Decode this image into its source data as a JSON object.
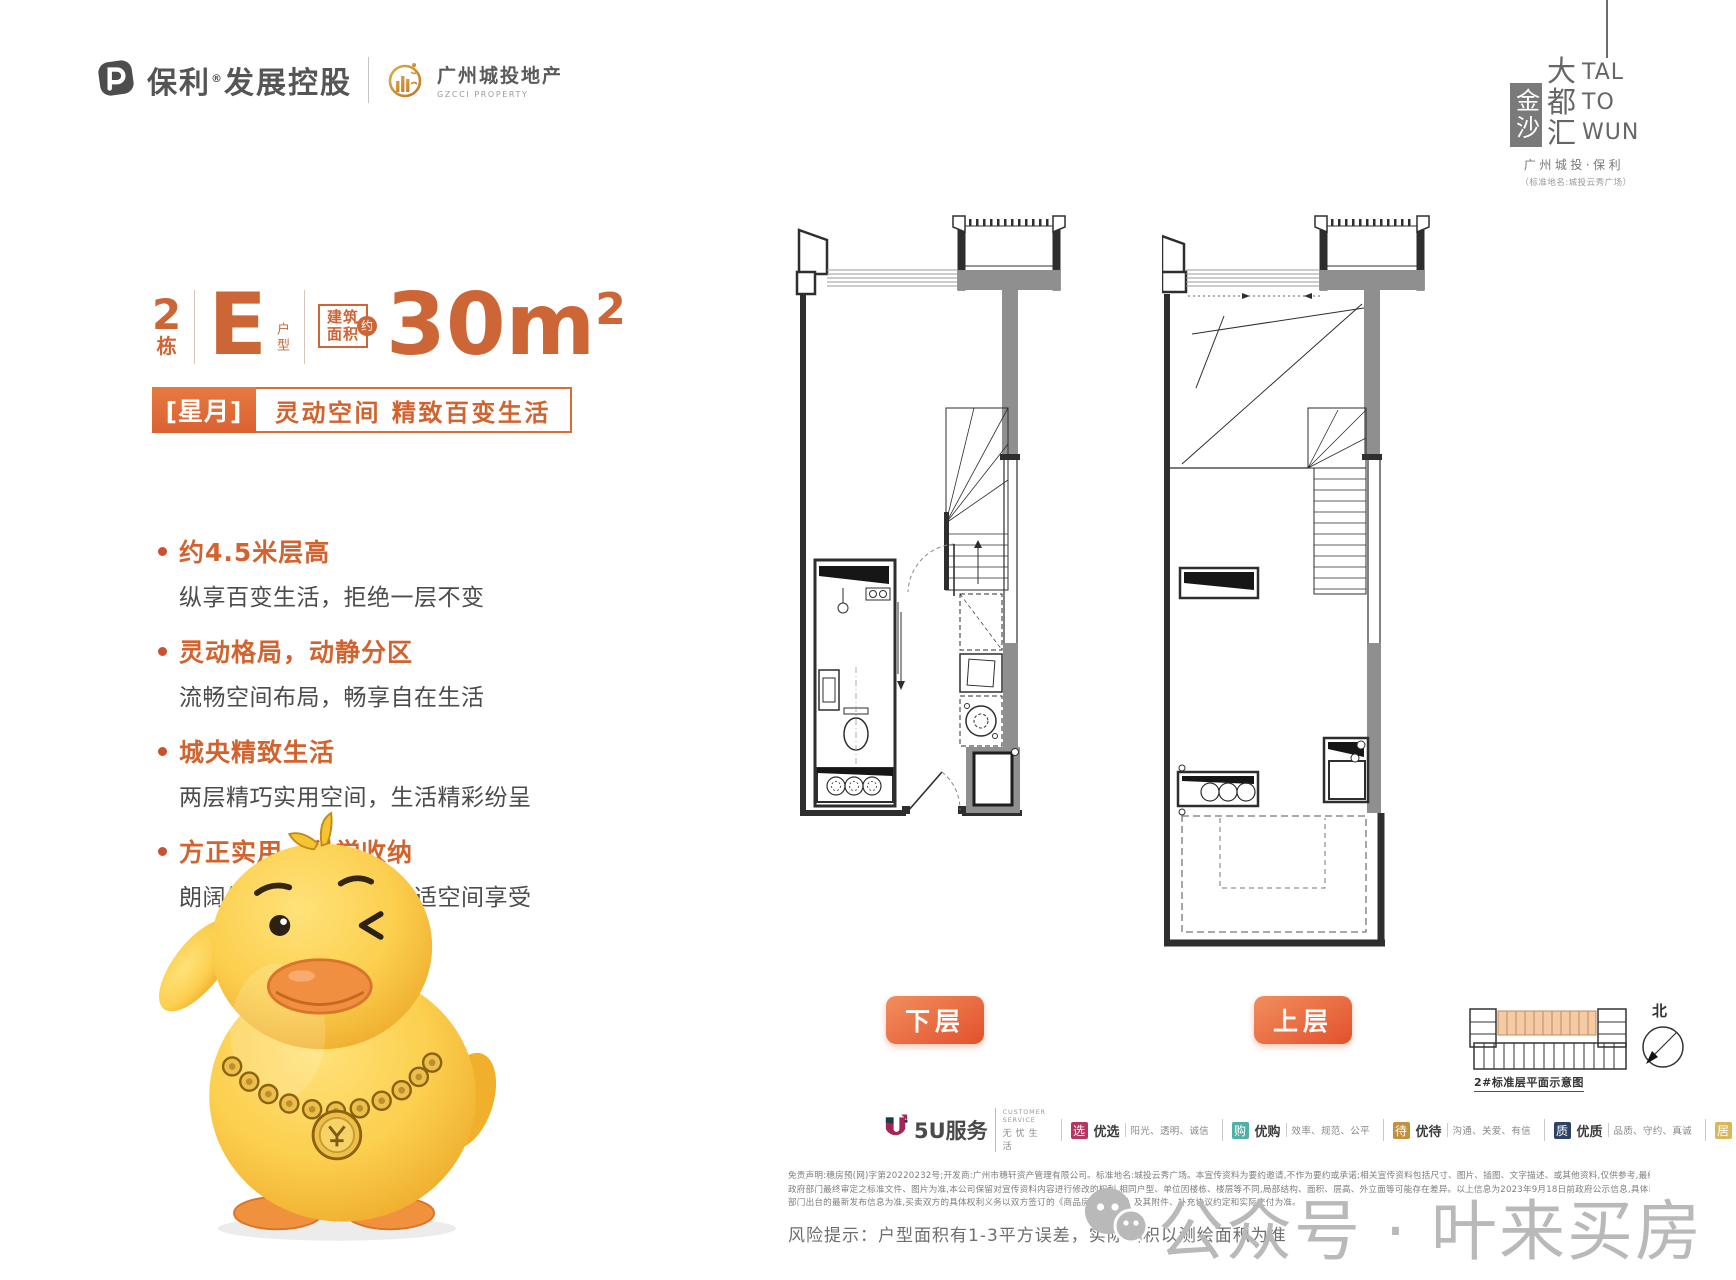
{
  "page": {
    "width": 1736,
    "height": 1280,
    "background": "#ffffff"
  },
  "colors": {
    "accent": "#d2622e",
    "banner_orange": "#dc6132",
    "wall_gray": "#8f8f8f",
    "watermark_gray": "#b9b9b9"
  },
  "header": {
    "poly_brand": "保利",
    "poly_reg": "®",
    "poly_suffix": "发展控股",
    "partner_name": "广州城投地产",
    "partner_sub": "GZCCI PROPERTY",
    "seal": "金沙",
    "project_chars": [
      "大",
      "都",
      "汇"
    ],
    "latin_lines": [
      "TAL",
      "TO",
      "WUN"
    ],
    "byline": "广州城投·保利",
    "standard_name": "（标准地名:城投云秀广场）"
  },
  "unit": {
    "building_no": "2",
    "building_suffix": "栋",
    "type_letter": "E",
    "type_label": "户型",
    "area_badge": [
      "建筑",
      "面积"
    ],
    "area_approx": "约",
    "area_value": "30m",
    "area_sup": "2",
    "tag": "[星月]",
    "tagline": "灵动空间 精致百变生活"
  },
  "features": [
    {
      "title": "约4.5米层高",
      "desc": "纵享百变生活，拒绝一层不变"
    },
    {
      "title": "灵动格局，动静分区",
      "desc": "流畅空间布局，畅享自在生活"
    },
    {
      "title": "城央精致生活",
      "desc": "两层精巧实用空间，生活精彩纷呈"
    },
    {
      "title": "方正实用，科学收纳",
      "desc": "朗阔纵向尺度，犒赏舒适空间享受"
    }
  ],
  "plans": {
    "lower_label": "下层",
    "upper_label": "上层",
    "keyplan_caption": "2#标准层平面示意图",
    "north_label": "北"
  },
  "service": {
    "logo_text": "5U服务",
    "caption_top": "CUSTOMER SERVICE",
    "caption_bottom": "无忧生活",
    "items": [
      {
        "icon": "选",
        "color": "#b73563",
        "label": "优选",
        "desc": "阳光、透明、诚信"
      },
      {
        "icon": "购",
        "color": "#4fb0a5",
        "label": "优购",
        "desc": "效率、规范、公平"
      },
      {
        "icon": "待",
        "color": "#c3903e",
        "label": "优待",
        "desc": "沟通、关爱、有信"
      },
      {
        "icon": "质",
        "color": "#2e4363",
        "label": "优质",
        "desc": "品质、守约、真诚"
      },
      {
        "icon": "居",
        "color": "#d8b75a",
        "label": "优居",
        "desc": "和睦、关怀、亲情"
      }
    ]
  },
  "legal": {
    "lines": [
      "免责声明:穗房预(网)字第20220232号;开发商:广州市穗轩资产管理有限公司。标准地名:城投云秀广场。本宣传资料为要约邀请,不作为要约或承诺;相关宣传资料包括尺寸、图片、插图、文字描述、或其他资料,仅供参考,最终以",
      "政府部门最终审定之标准文件、图片为准,本公司保留对宣传资料内容进行修改的权利,相同户型、单位因楼栋、楼层等不同,局部结构、面积、层高、外立面等可能存在差异。以上信息为2023年9月18日前政府公示信息,具体以政府",
      "部门出台的最新发布信息为准,买卖双方的具体权利义务以双方签订的《商品房买卖合同》及其附件、补充协议约定和实际交付为准。"
    ],
    "risk": "风险提示：户型面积有1-3平方误差，实际面积以测绘面积为准"
  },
  "watermark": {
    "text": "公众号 · 叶来买房"
  }
}
